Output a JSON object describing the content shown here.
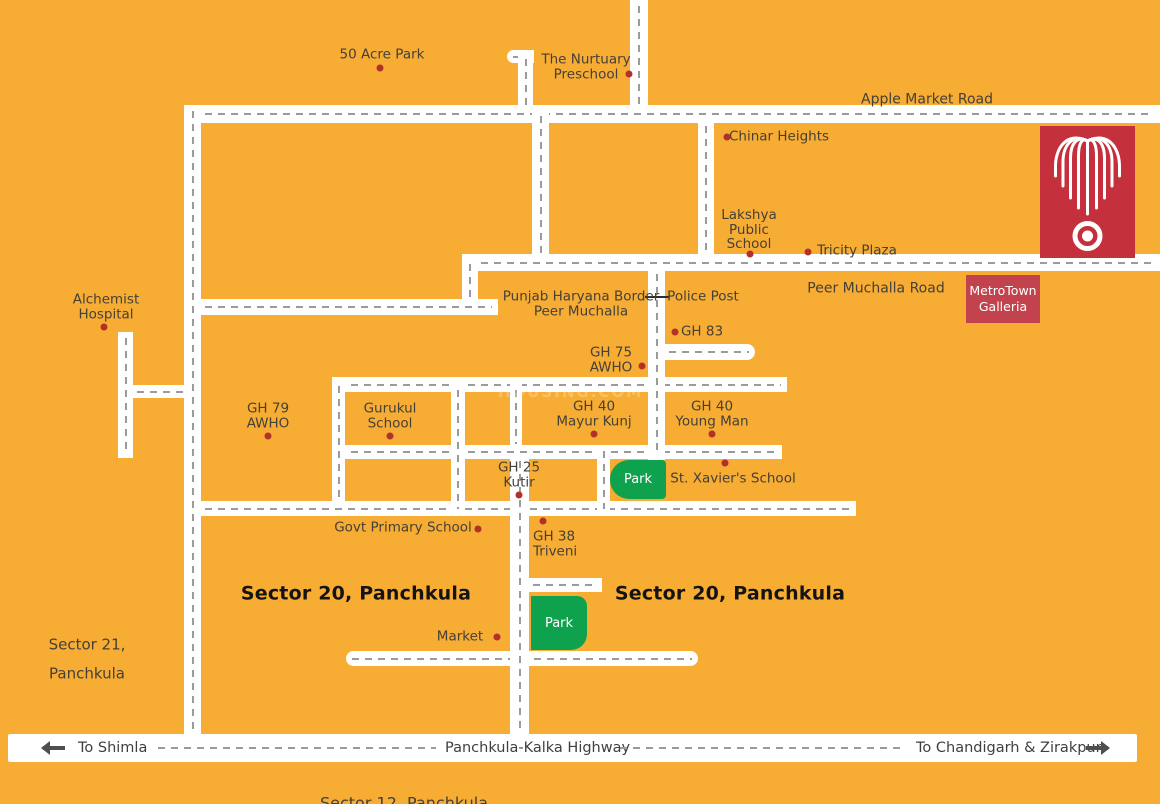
{
  "colors": {
    "background": "#F7AC33",
    "road": "#FFFFFF",
    "dash": "#9B9B9B",
    "dot": "#B1312B",
    "park_green": "#0FA24E",
    "logo_red": "#C4303C",
    "galleria_red": "#C2434D",
    "text": "#454038",
    "arrow_gray": "#4F4F4F"
  },
  "watermark": "HOUSING.COM",
  "galleria": {
    "line1": "MetroTown",
    "line2": "Galleria"
  },
  "highway": {
    "to_left": "To Shimla",
    "name": "Panchkula-Kalka Highway",
    "to_right": "To Chandigarh & Zirakpur"
  },
  "labels": [
    {
      "id": "50-acre-park",
      "text": "50 Acre Park",
      "x": 382,
      "y": 55
    },
    {
      "id": "nurtuary-preschool",
      "text": "The Nurtuary\nPreschool",
      "x": 586,
      "y": 67
    },
    {
      "id": "apple-market-road",
      "text": "Apple Market Road",
      "x": 927,
      "y": 100,
      "size": 14
    },
    {
      "id": "chinar-heights",
      "text": "Chinar Heights",
      "x": 779,
      "y": 137
    },
    {
      "id": "lakshya-public-school",
      "text": "Lakshya\nPublic\nSchool",
      "x": 749,
      "y": 230
    },
    {
      "id": "tricity-plaza",
      "text": "Tricity Plaza",
      "x": 857,
      "y": 251
    },
    {
      "id": "peer-muchalla-road",
      "text": "Peer Muchalla Road",
      "x": 876,
      "y": 289,
      "size": 14
    },
    {
      "id": "punjab-haryana-border",
      "text": "Punjab Haryana Border\nPeer Muchalla",
      "x": 581,
      "y": 304
    },
    {
      "id": "police-post",
      "text": "Police Post",
      "x": 703,
      "y": 297
    },
    {
      "id": "gh-83",
      "text": "GH 83",
      "x": 702,
      "y": 332
    },
    {
      "id": "gh-75-awho",
      "text": "GH 75\nAWHO",
      "x": 611,
      "y": 360
    },
    {
      "id": "alchemist-hospital",
      "text": "Alchemist\nHospital",
      "x": 106,
      "y": 307
    },
    {
      "id": "gh-79-awho",
      "text": "GH 79\nAWHO",
      "x": 268,
      "y": 416
    },
    {
      "id": "gurukul-school",
      "text": "Gurukul\nSchool",
      "x": 390,
      "y": 416
    },
    {
      "id": "gh-40-mayur-kunj",
      "text": "GH 40\nMayur Kunj",
      "x": 594,
      "y": 414
    },
    {
      "id": "gh-40-young-man",
      "text": "GH 40\nYoung Man",
      "x": 712,
      "y": 414
    },
    {
      "id": "gh-25-kutir",
      "text": "GH 25\nKutir",
      "x": 519,
      "y": 475
    },
    {
      "id": "st-xaviers-school",
      "text": "St. Xavier's School",
      "x": 733,
      "y": 479
    },
    {
      "id": "govt-primary-school",
      "text": "Govt Primary School",
      "x": 403,
      "y": 528
    },
    {
      "id": "gh-38-triveni",
      "text": "GH 38\nTriveni",
      "x": 533,
      "y": 544,
      "align": "left"
    },
    {
      "id": "sector-20-left",
      "text": "Sector 20, Panchkula",
      "x": 356,
      "y": 594,
      "bold": true,
      "size": 19
    },
    {
      "id": "sector-20-right",
      "text": "Sector 20, Panchkula",
      "x": 730,
      "y": 594,
      "bold": true,
      "size": 19
    },
    {
      "id": "market",
      "text": "Market",
      "x": 460,
      "y": 637
    },
    {
      "id": "sector-21",
      "text": "Sector 21,\nPanchkula",
      "x": 87,
      "y": 659,
      "size": 15,
      "lh": 1.9
    },
    {
      "id": "sector-12",
      "text": "Sector 12, Panchkula",
      "x": 404,
      "y": 803,
      "size": 16
    }
  ],
  "dots": [
    {
      "x": 380,
      "y": 68
    },
    {
      "x": 629,
      "y": 74
    },
    {
      "x": 727,
      "y": 137
    },
    {
      "x": 750,
      "y": 254
    },
    {
      "x": 808,
      "y": 252
    },
    {
      "x": 675,
      "y": 332
    },
    {
      "x": 642,
      "y": 366
    },
    {
      "x": 104,
      "y": 327
    },
    {
      "x": 268,
      "y": 436
    },
    {
      "x": 390,
      "y": 436
    },
    {
      "x": 594,
      "y": 434
    },
    {
      "x": 712,
      "y": 434
    },
    {
      "x": 519,
      "y": 495
    },
    {
      "x": 725,
      "y": 463
    },
    {
      "x": 478,
      "y": 529
    },
    {
      "x": 543,
      "y": 521
    },
    {
      "x": 497,
      "y": 637
    }
  ],
  "parks": [
    {
      "label": "Park",
      "x": 610,
      "y": 460,
      "w": 56,
      "h": 39,
      "radius": "19px 4px 4px 19px"
    },
    {
      "label": "Park",
      "x": 531,
      "y": 596,
      "w": 56,
      "h": 54,
      "radius": "0 10px 16px 0"
    }
  ]
}
